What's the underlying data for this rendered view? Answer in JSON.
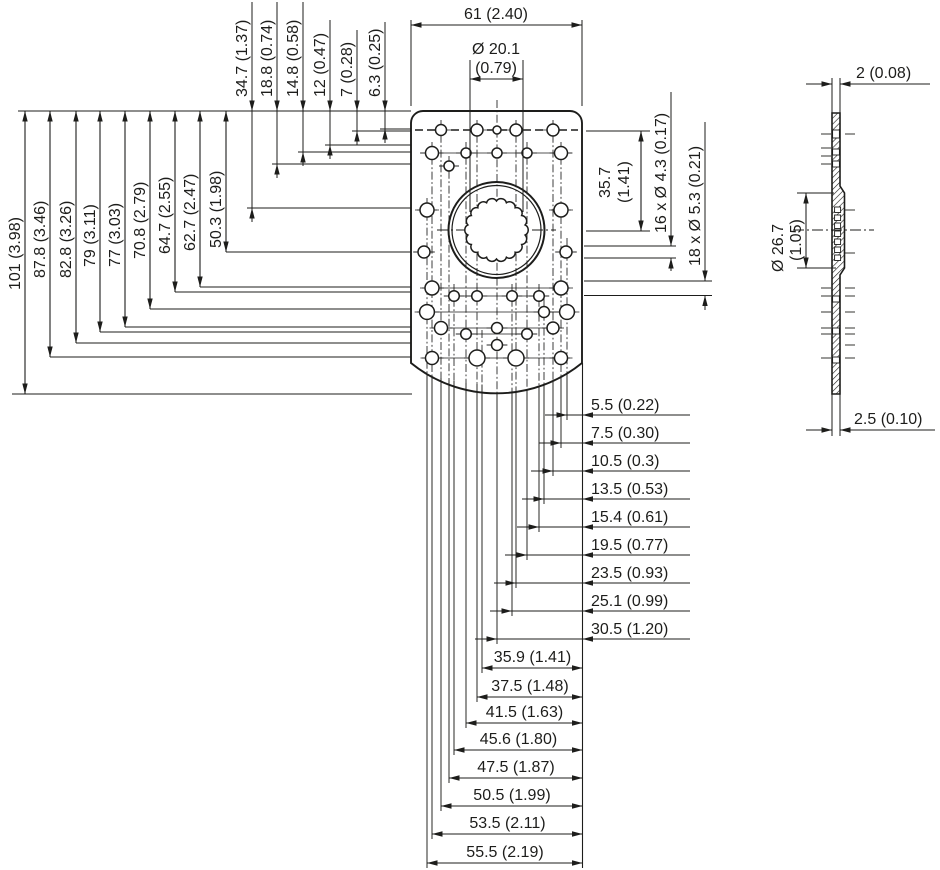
{
  "colors": {
    "line": "#1d1d1b",
    "background": "#ffffff"
  },
  "front_view": {
    "width_dim": "61 (2.40)",
    "bore_dim": {
      "line1": "Ø 20.1",
      "line2": "(0.79)"
    },
    "top_edge_dims": [
      "34.7 (1.37)",
      "18.8 (0.74)",
      "14.8 (0.58)",
      "12 (0.47)",
      "7 (0.28)",
      "6.3 (0.25)"
    ],
    "left_edge_dims": [
      "101 (3.98)",
      "87.8 (3.46)",
      "82.8 (3.26)",
      "79 (3.11)",
      "77 (3.03)",
      "70.8 (2.79)",
      "64.7 (2.55)",
      "62.7 (2.47)",
      "50.3 (1.98)"
    ],
    "right_dims": {
      "row_height_line1": "35.7",
      "row_height_line2": "(1.41)",
      "small_hole_callout": "16 x Ø 4.3 (0.17)",
      "large_hole_callout": "18 x Ø 5.3 (0.21)"
    },
    "bottom_dims_from_edge": [
      "5.5 (0.22)",
      "7.5 (0.30)",
      "10.5 (0.3)",
      "13.5 (0.53)",
      "15.4 (0.61)",
      "19.5 (0.77)",
      "23.5 (0.93)",
      "25.1 (0.99)",
      "30.5 (1.20)"
    ],
    "bottom_dims_spans": [
      "35.9 (1.41)",
      "37.5 (1.48)",
      "41.5 (1.63)",
      "45.6 (1.80)",
      "47.5 (1.87)",
      "50.5 (1.99)",
      "53.5 (2.11)",
      "55.5 (2.19)"
    ]
  },
  "side_view": {
    "thickness_top": "2 (0.08)",
    "thickness_bottom": "2.5 (0.10)",
    "hub_dim_line1": "Ø 26.7",
    "hub_dim_line2": "(1.05)"
  }
}
